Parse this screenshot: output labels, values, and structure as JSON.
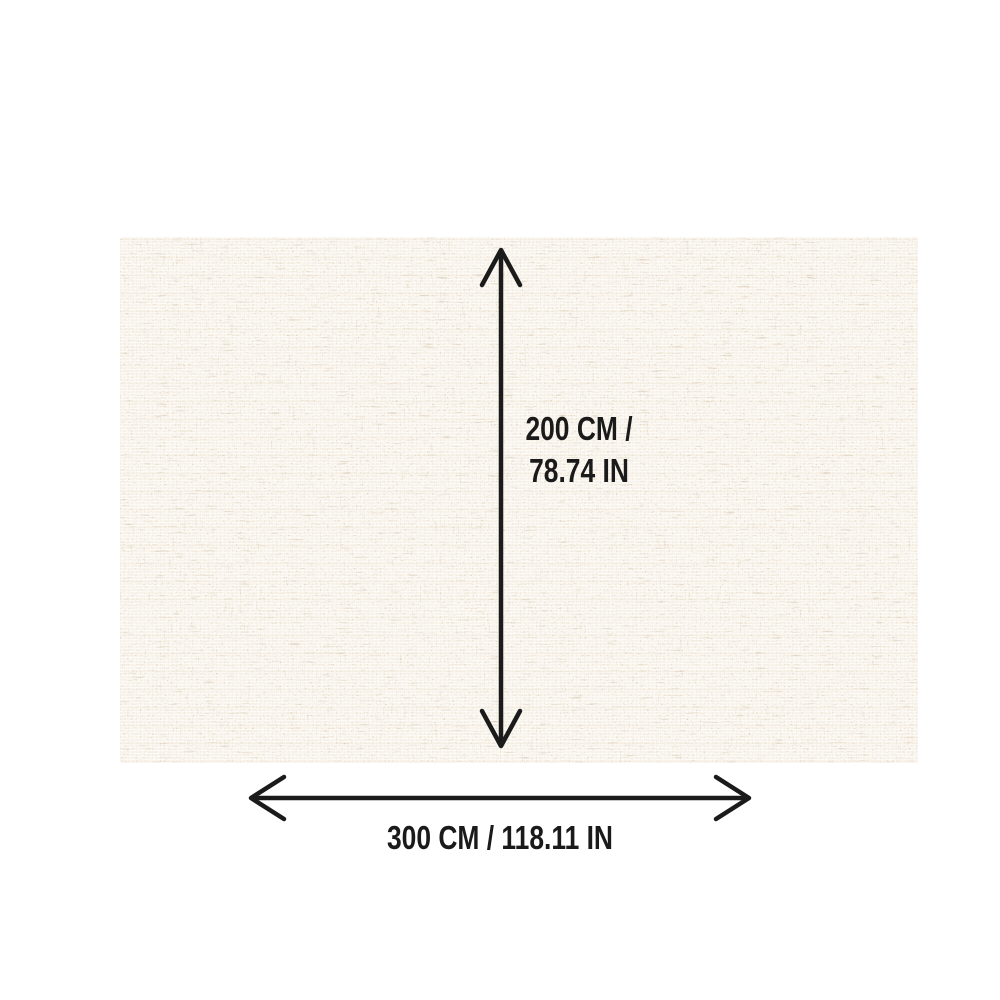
{
  "page": {
    "background_color": "#ffffff"
  },
  "rug": {
    "description": "cream woven linen rug swatch with tan speckled crosshatch texture",
    "base_color": "#faf6ef",
    "speckle_color": "#b3946b",
    "dark_speckle_color": "#8a6f4e"
  },
  "dimensions": {
    "arrow_color": "#1b1b1b",
    "text_color": "#1a1a1a",
    "height": {
      "line1": "200 CM /",
      "line2": "78.74 IN"
    },
    "width": {
      "label": "300 CM / 118.11 IN"
    }
  }
}
